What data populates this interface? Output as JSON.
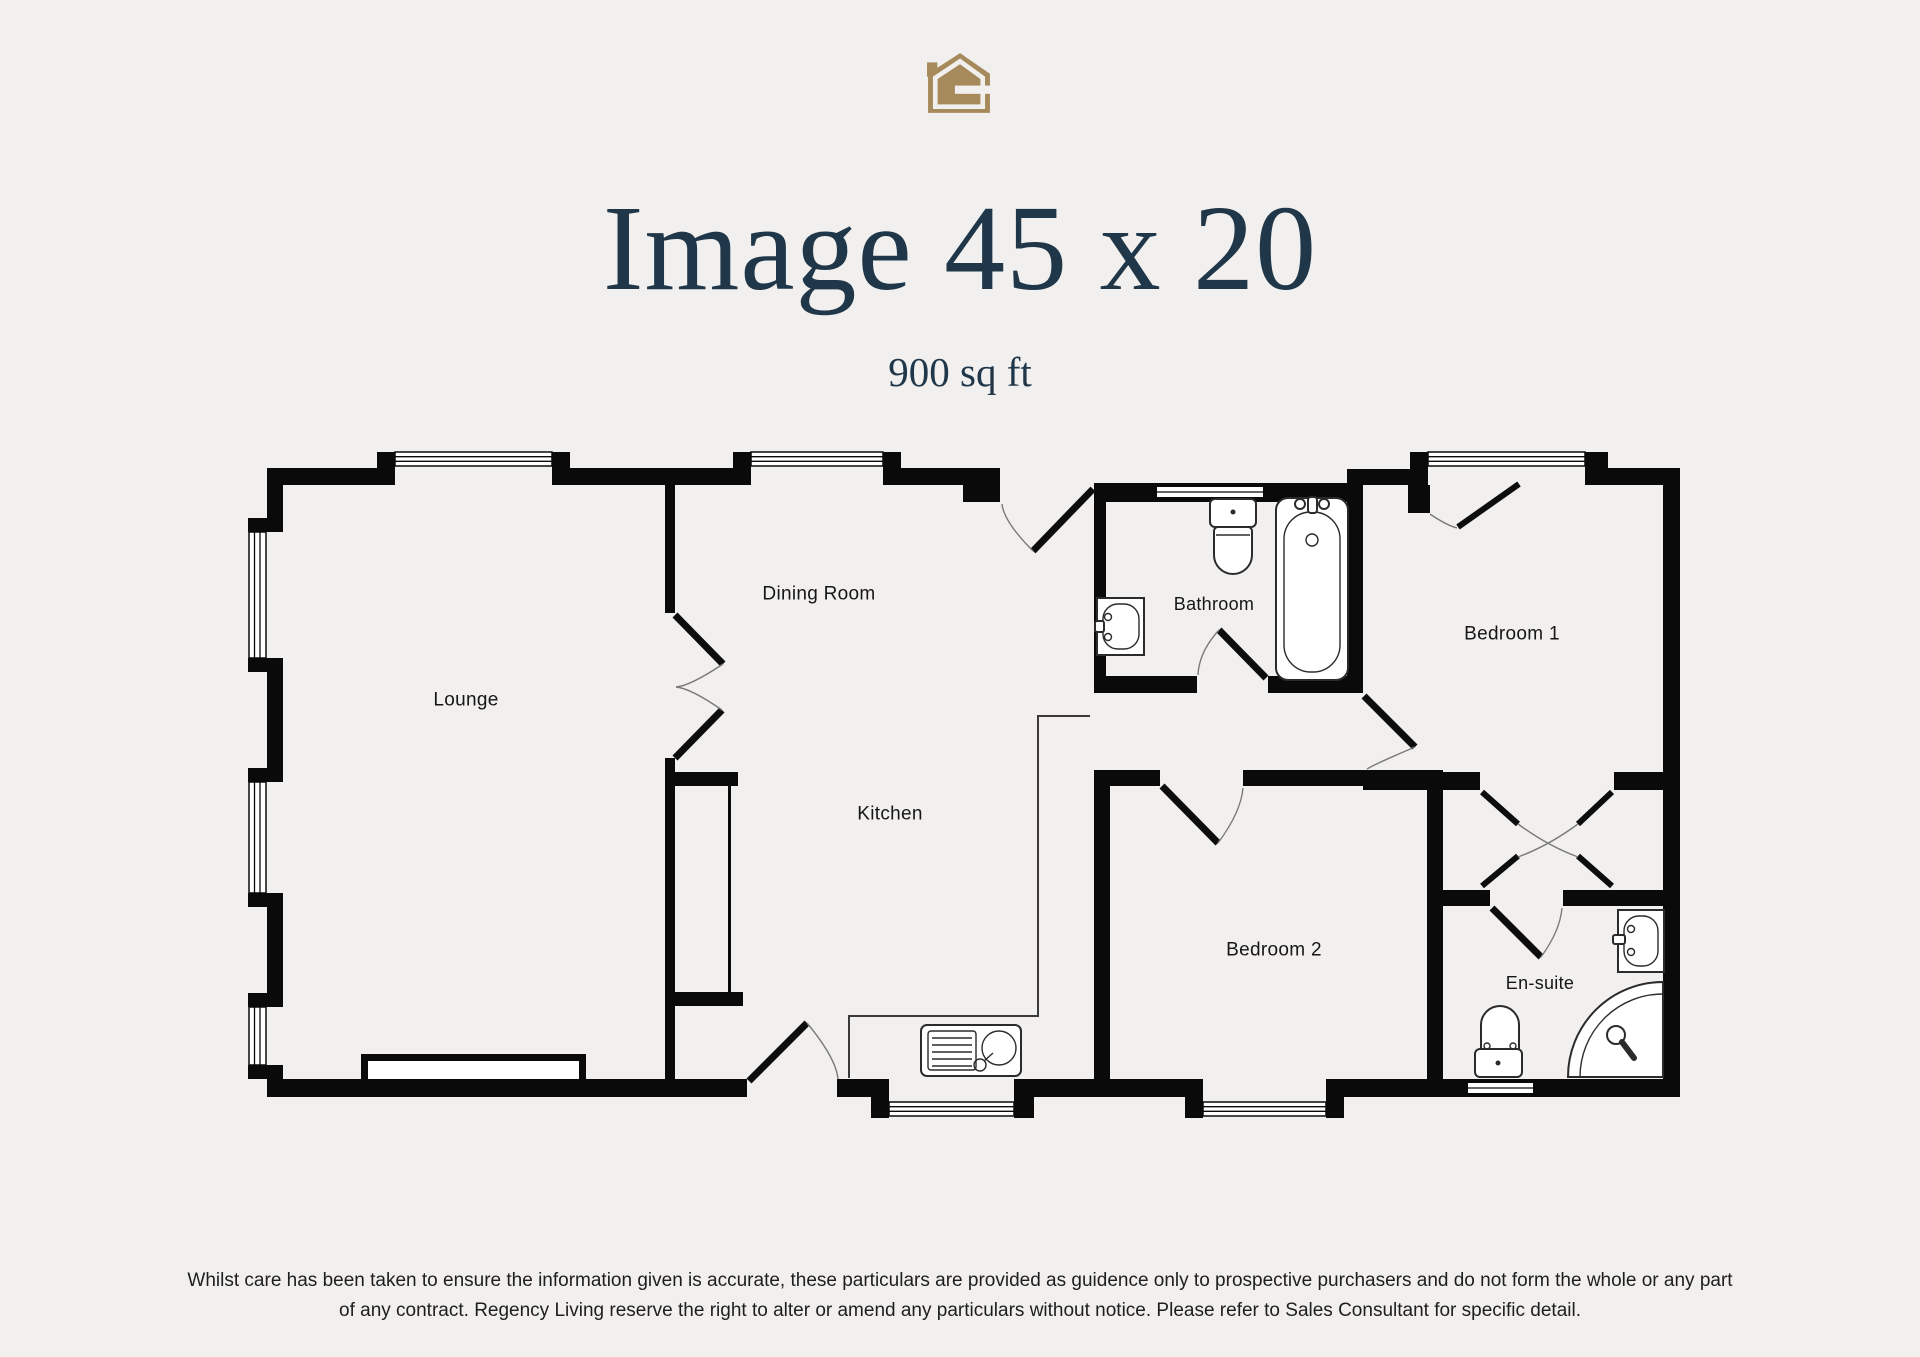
{
  "header": {
    "title": "Image 45 x 20",
    "subtitle": "900 sq ft"
  },
  "logo": {
    "name": "regency-living-house-logo",
    "gold": "#a68a5b"
  },
  "colors": {
    "background": "#f1f0ee",
    "title_text": "#20374a",
    "walls": "#0a0a0a"
  },
  "plan": {
    "rooms": [
      {
        "name": "Lounge"
      },
      {
        "name": "Dining Room"
      },
      {
        "name": "Kitchen"
      },
      {
        "name": "Bathroom"
      },
      {
        "name": "Bedroom 1"
      },
      {
        "name": "Bedroom 2"
      },
      {
        "name": "En-suite"
      }
    ]
  },
  "footer": {
    "line1": "Whilst care has been taken to ensure the information given is accurate, these particulars are provided as guidence only to prospective purchasers and do not form the whole or any part",
    "line2": "of any contract. Regency Living reserve the right to alter or amend any particulars without notice. Please refer to Sales Consultant for specific detail."
  }
}
